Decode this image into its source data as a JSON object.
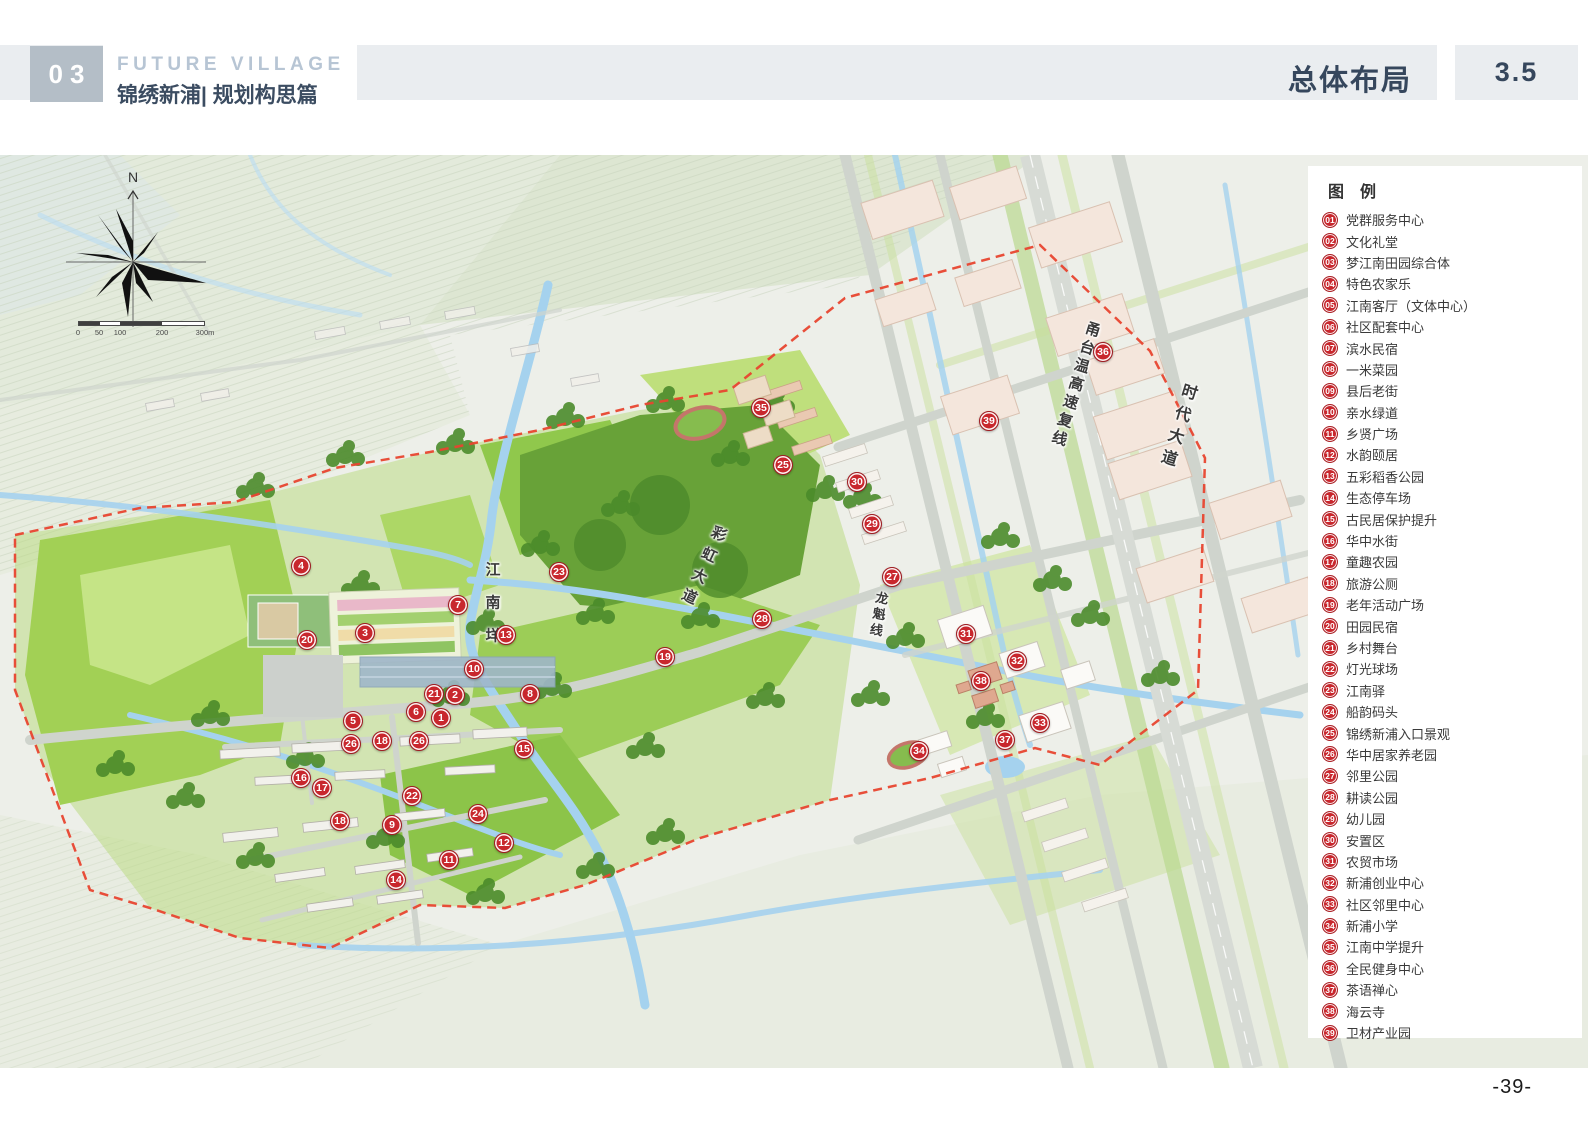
{
  "header": {
    "chapter_no": "03",
    "title_en": "FUTURE VILLAGE",
    "title_cn": "锦绣新浦| 规划构思篇",
    "section_title": "总体布局",
    "section_no": "3.5"
  },
  "compass": {
    "north": "N"
  },
  "scale_bar": {
    "labels": [
      "0",
      "50",
      "100",
      "200",
      "300m"
    ]
  },
  "map": {
    "road_labels": [
      {
        "text": "甬台温高速复线",
        "x": 1075,
        "y": 230,
        "rot": 17,
        "fs": 15,
        "ls": 4
      },
      {
        "text": "时代大道",
        "x": 1176,
        "y": 272,
        "rot": 17,
        "fs": 16,
        "ls": 7
      },
      {
        "text": "彩虹大道",
        "x": 702,
        "y": 413,
        "rot": 25,
        "fs": 15,
        "ls": 8
      },
      {
        "text": "龙魁线",
        "x": 878,
        "y": 460,
        "rot": 10,
        "fs": 13,
        "ls": 3
      },
      {
        "text": "江南垟",
        "x": 492,
        "y": 456,
        "rot": 0,
        "fs": 15,
        "ls": 18
      }
    ],
    "markers": [
      {
        "num": "1",
        "x": 441,
        "y": 563
      },
      {
        "num": "2",
        "x": 455,
        "y": 540
      },
      {
        "num": "3",
        "x": 365,
        "y": 478
      },
      {
        "num": "4",
        "x": 301,
        "y": 411
      },
      {
        "num": "5",
        "x": 353,
        "y": 566
      },
      {
        "num": "6",
        "x": 416,
        "y": 557
      },
      {
        "num": "7",
        "x": 458,
        "y": 450
      },
      {
        "num": "8",
        "x": 530,
        "y": 539
      },
      {
        "num": "9",
        "x": 392,
        "y": 670
      },
      {
        "num": "10",
        "x": 474,
        "y": 514
      },
      {
        "num": "11",
        "x": 449,
        "y": 705
      },
      {
        "num": "12",
        "x": 504,
        "y": 688
      },
      {
        "num": "13",
        "x": 506,
        "y": 480
      },
      {
        "num": "14",
        "x": 396,
        "y": 725
      },
      {
        "num": "15",
        "x": 524,
        "y": 594
      },
      {
        "num": "16",
        "x": 301,
        "y": 623
      },
      {
        "num": "17",
        "x": 322,
        "y": 633
      },
      {
        "num": "18",
        "x": 382,
        "y": 586
      },
      {
        "num": "18",
        "x": 340,
        "y": 666
      },
      {
        "num": "19",
        "x": 665,
        "y": 502
      },
      {
        "num": "20",
        "x": 307,
        "y": 485
      },
      {
        "num": "21",
        "x": 434,
        "y": 539
      },
      {
        "num": "22",
        "x": 412,
        "y": 641
      },
      {
        "num": "23",
        "x": 559,
        "y": 417
      },
      {
        "num": "24",
        "x": 478,
        "y": 659
      },
      {
        "num": "25",
        "x": 783,
        "y": 310
      },
      {
        "num": "26",
        "x": 351,
        "y": 589
      },
      {
        "num": "26",
        "x": 419,
        "y": 586
      },
      {
        "num": "27",
        "x": 892,
        "y": 422
      },
      {
        "num": "28",
        "x": 762,
        "y": 464
      },
      {
        "num": "29",
        "x": 872,
        "y": 369
      },
      {
        "num": "30",
        "x": 857,
        "y": 327
      },
      {
        "num": "31",
        "x": 966,
        "y": 479
      },
      {
        "num": "32",
        "x": 1017,
        "y": 506
      },
      {
        "num": "33",
        "x": 1040,
        "y": 568
      },
      {
        "num": "34",
        "x": 919,
        "y": 596
      },
      {
        "num": "35",
        "x": 761,
        "y": 253
      },
      {
        "num": "36",
        "x": 1103,
        "y": 197
      },
      {
        "num": "37",
        "x": 1005,
        "y": 585
      },
      {
        "num": "38",
        "x": 981,
        "y": 526
      },
      {
        "num": "39",
        "x": 989,
        "y": 266
      }
    ]
  },
  "legend": {
    "title": "图 例",
    "items": [
      {
        "num": "01",
        "label": "党群服务中心"
      },
      {
        "num": "02",
        "label": "文化礼堂"
      },
      {
        "num": "03",
        "label": "梦江南田园综合体"
      },
      {
        "num": "04",
        "label": "特色农家乐"
      },
      {
        "num": "05",
        "label": "江南客厅（文体中心）"
      },
      {
        "num": "06",
        "label": "社区配套中心"
      },
      {
        "num": "07",
        "label": "滨水民宿"
      },
      {
        "num": "08",
        "label": "一米菜园"
      },
      {
        "num": "09",
        "label": "县后老街"
      },
      {
        "num": "10",
        "label": "亲水绿道"
      },
      {
        "num": "11",
        "label": "乡贤广场"
      },
      {
        "num": "12",
        "label": "水韵颐居"
      },
      {
        "num": "13",
        "label": "五彩稻香公园"
      },
      {
        "num": "14",
        "label": "生态停车场"
      },
      {
        "num": "15",
        "label": "古民居保护提升"
      },
      {
        "num": "16",
        "label": "华中水街"
      },
      {
        "num": "17",
        "label": "童趣农园"
      },
      {
        "num": "18",
        "label": "旅游公厕"
      },
      {
        "num": "19",
        "label": "老年活动广场"
      },
      {
        "num": "20",
        "label": "田园民宿"
      },
      {
        "num": "21",
        "label": "乡村舞台"
      },
      {
        "num": "22",
        "label": "灯光球场"
      },
      {
        "num": "23",
        "label": "江南驿"
      },
      {
        "num": "24",
        "label": "船韵码头"
      },
      {
        "num": "25",
        "label": "锦绣新浦入口景观"
      },
      {
        "num": "26",
        "label": "华中居家养老园"
      },
      {
        "num": "27",
        "label": "邻里公园"
      },
      {
        "num": "28",
        "label": "耕读公园"
      },
      {
        "num": "29",
        "label": "幼儿园"
      },
      {
        "num": "30",
        "label": "安置区"
      },
      {
        "num": "31",
        "label": "农贸市场"
      },
      {
        "num": "32",
        "label": "新浦创业中心"
      },
      {
        "num": "33",
        "label": "社区邻里中心"
      },
      {
        "num": "34",
        "label": "新浦小学"
      },
      {
        "num": "35",
        "label": "江南中学提升"
      },
      {
        "num": "36",
        "label": "全民健身中心"
      },
      {
        "num": "37",
        "label": "茶语禅心"
      },
      {
        "num": "38",
        "label": "海云寺"
      },
      {
        "num": "39",
        "label": "卫材产业园"
      }
    ]
  },
  "footer": {
    "page_number": "-39-"
  },
  "colors": {
    "marker_red": "#c8272d",
    "boundary_red": "#e8442f",
    "header_navy": "#3b4c61",
    "header_band_gray": "#eaedf0",
    "field_green": "#a2d055",
    "water_blue": "#a5d2ee"
  }
}
